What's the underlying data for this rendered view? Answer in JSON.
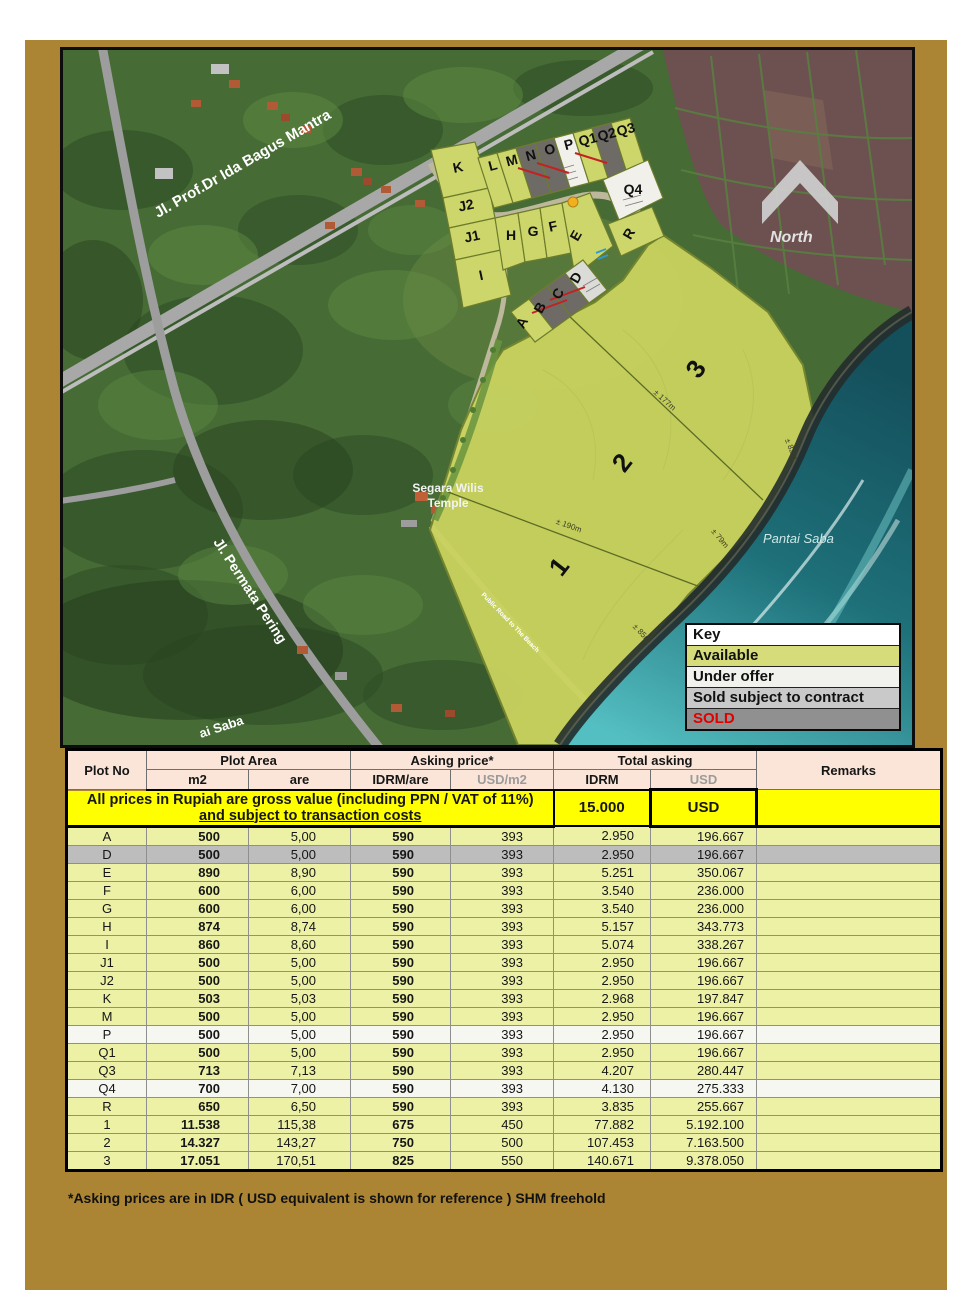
{
  "map": {
    "roads": {
      "main": "Jl. Prof.Dr Ida Bagus Mantra",
      "secondary": "Jl. Permata Pering",
      "corner": "ai Saba",
      "beach_road": "Public Road to The Beach"
    },
    "labels": {
      "north": "North",
      "temple_line1": "Segara Wilis",
      "temple_line2": "Temple",
      "beach": "Pantai Saba"
    },
    "dimensions": [
      "± 177m",
      "± 190m",
      "± 82m",
      "± 79m",
      "± 85m"
    ],
    "plots": [
      {
        "id": "K",
        "status": "available"
      },
      {
        "id": "J2",
        "status": "available"
      },
      {
        "id": "J1",
        "status": "available"
      },
      {
        "id": "I",
        "status": "available"
      },
      {
        "id": "L",
        "status": "available"
      },
      {
        "id": "M",
        "status": "available"
      },
      {
        "id": "N",
        "status": "sold"
      },
      {
        "id": "O",
        "status": "sold"
      },
      {
        "id": "P",
        "status": "under_offer"
      },
      {
        "id": "Q1",
        "status": "available"
      },
      {
        "id": "Q2",
        "status": "sold"
      },
      {
        "id": "Q3",
        "status": "available"
      },
      {
        "id": "Q4",
        "status": "under_offer"
      },
      {
        "id": "R",
        "status": "available"
      },
      {
        "id": "H",
        "status": "available"
      },
      {
        "id": "G",
        "status": "available"
      },
      {
        "id": "F",
        "status": "available"
      },
      {
        "id": "E",
        "status": "available"
      },
      {
        "id": "A",
        "status": "available"
      },
      {
        "id": "B",
        "status": "sold"
      },
      {
        "id": "C",
        "status": "sold"
      },
      {
        "id": "D",
        "status": "sold_stc"
      },
      {
        "id": "1",
        "status": "available"
      },
      {
        "id": "2",
        "status": "available"
      },
      {
        "id": "3",
        "status": "available"
      }
    ]
  },
  "key": {
    "title": "Key",
    "items": [
      {
        "label": "Available",
        "status": "available"
      },
      {
        "label": "Under offer",
        "status": "under_offer"
      },
      {
        "label": "Sold subject to contract",
        "status": "sold_stc"
      },
      {
        "label": "SOLD",
        "status": "sold"
      }
    ]
  },
  "notice": {
    "line1": "All prices in Rupiah are gross value (including PPN / VAT of 11%)",
    "line2": "and subject to transaction costs",
    "rate": "15.000",
    "currency": "USD"
  },
  "table": {
    "headers": {
      "plot_no": "Plot No",
      "plot_area": "Plot Area",
      "m2": "m2",
      "are": "are",
      "asking_price": "Asking price*",
      "idrm_are": "IDRM/are",
      "usd_m2": "USD/m2",
      "total_asking": "Total asking",
      "idrm": "IDRM",
      "usd": "USD",
      "remarks": "Remarks"
    },
    "rows": [
      {
        "plot": "A",
        "m2": "500",
        "are": "5,00",
        "idrm_are": "590",
        "usd_m2": "393",
        "idrm": "2.950",
        "usd": "196.667",
        "status": "available"
      },
      {
        "plot": "D",
        "m2": "500",
        "are": "5,00",
        "idrm_are": "590",
        "usd_m2": "393",
        "idrm": "2.950",
        "usd": "196.667",
        "status": "sold_stc"
      },
      {
        "plot": "E",
        "m2": "890",
        "are": "8,90",
        "idrm_are": "590",
        "usd_m2": "393",
        "idrm": "5.251",
        "usd": "350.067",
        "status": "available"
      },
      {
        "plot": "F",
        "m2": "600",
        "are": "6,00",
        "idrm_are": "590",
        "usd_m2": "393",
        "idrm": "3.540",
        "usd": "236.000",
        "status": "available"
      },
      {
        "plot": "G",
        "m2": "600",
        "are": "6,00",
        "idrm_are": "590",
        "usd_m2": "393",
        "idrm": "3.540",
        "usd": "236.000",
        "status": "available"
      },
      {
        "plot": "H",
        "m2": "874",
        "are": "8,74",
        "idrm_are": "590",
        "usd_m2": "393",
        "idrm": "5.157",
        "usd": "343.773",
        "status": "available"
      },
      {
        "plot": "I",
        "m2": "860",
        "are": "8,60",
        "idrm_are": "590",
        "usd_m2": "393",
        "idrm": "5.074",
        "usd": "338.267",
        "status": "available"
      },
      {
        "plot": "J1",
        "m2": "500",
        "are": "5,00",
        "idrm_are": "590",
        "usd_m2": "393",
        "idrm": "2.950",
        "usd": "196.667",
        "status": "available"
      },
      {
        "plot": "J2",
        "m2": "500",
        "are": "5,00",
        "idrm_are": "590",
        "usd_m2": "393",
        "idrm": "2.950",
        "usd": "196.667",
        "status": "available"
      },
      {
        "plot": "K",
        "m2": "503",
        "are": "5,03",
        "idrm_are": "590",
        "usd_m2": "393",
        "idrm": "2.968",
        "usd": "197.847",
        "status": "available"
      },
      {
        "plot": "M",
        "m2": "500",
        "are": "5,00",
        "idrm_are": "590",
        "usd_m2": "393",
        "idrm": "2.950",
        "usd": "196.667",
        "status": "available"
      },
      {
        "plot": "P",
        "m2": "500",
        "are": "5,00",
        "idrm_are": "590",
        "usd_m2": "393",
        "idrm": "2.950",
        "usd": "196.667",
        "status": "under_offer"
      },
      {
        "plot": "Q1",
        "m2": "500",
        "are": "5,00",
        "idrm_are": "590",
        "usd_m2": "393",
        "idrm": "2.950",
        "usd": "196.667",
        "status": "available"
      },
      {
        "plot": "Q3",
        "m2": "713",
        "are": "7,13",
        "idrm_are": "590",
        "usd_m2": "393",
        "idrm": "4.207",
        "usd": "280.447",
        "status": "available"
      },
      {
        "plot": "Q4",
        "m2": "700",
        "are": "7,00",
        "idrm_are": "590",
        "usd_m2": "393",
        "idrm": "4.130",
        "usd": "275.333",
        "status": "under_offer"
      },
      {
        "plot": "R",
        "m2": "650",
        "are": "6,50",
        "idrm_are": "590",
        "usd_m2": "393",
        "idrm": "3.835",
        "usd": "255.667",
        "status": "available"
      },
      {
        "plot": "1",
        "m2": "11.538",
        "are": "115,38",
        "idrm_are": "675",
        "usd_m2": "450",
        "idrm": "77.882",
        "usd": "5.192.100",
        "status": "available"
      },
      {
        "plot": "2",
        "m2": "14.327",
        "are": "143,27",
        "idrm_are": "750",
        "usd_m2": "500",
        "idrm": "107.453",
        "usd": "7.163.500",
        "status": "available"
      },
      {
        "plot": "3",
        "m2": "17.051",
        "are": "170,51",
        "idrm_are": "825",
        "usd_m2": "550",
        "idrm": "140.671",
        "usd": "9.378.050",
        "status": "available"
      }
    ]
  },
  "footnote": "*Asking prices are in IDR ( USD equivalent is shown for reference ) SHM freehold",
  "colors": {
    "available": "#cdd66a",
    "under_offer": "#f1f0ea",
    "sold": "#6e6a66",
    "sold_stc": "#dbdbd7",
    "key_available": "#d6dc7a",
    "key_under_offer": "#f1f1ed",
    "key_sold_stc": "#c9c9c9",
    "key_sold": "#909090",
    "row_available": "#ecf1a6",
    "row_under_offer": "#f7f7f2",
    "row_sold_stc": "#bdbdbd",
    "sold_text": "#e00000",
    "accent_yellow": "#ffff00"
  }
}
